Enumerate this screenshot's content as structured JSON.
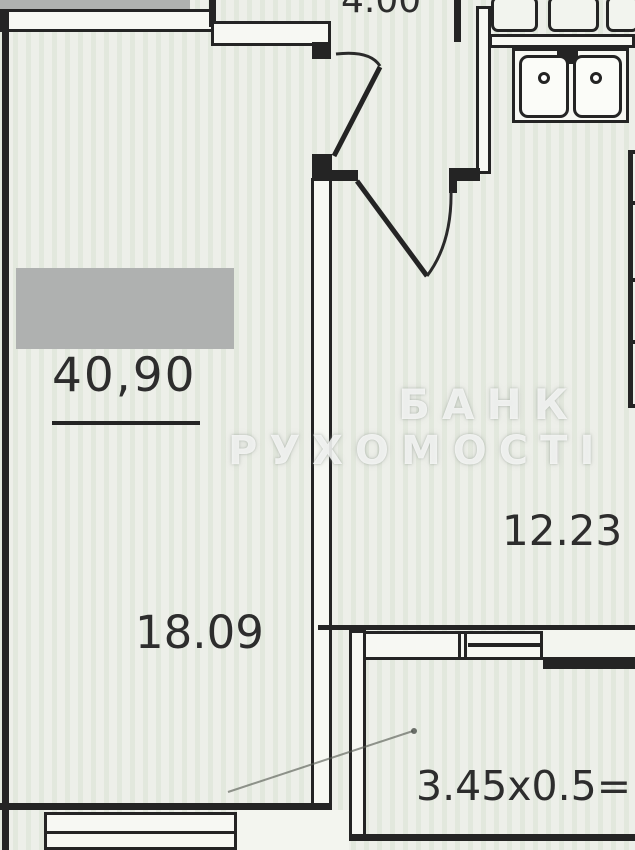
{
  "plan": {
    "description": "apartment floor plan (scanned photo)",
    "labels": {
      "total_area": "40,90",
      "living_room_area": "18.09",
      "kitchen_area": "12.23",
      "corridor_formula": "3.45x0.5=1",
      "top_dimension": "4.00"
    },
    "watermark": {
      "line1": "БАНК",
      "line2": "РУХОМОСТІ"
    },
    "fixtures": [
      "double-sink",
      "wardrobe",
      "kitchen-cabinets",
      "window",
      "door-swings"
    ],
    "colors": {
      "paper": "#edefe9",
      "wall_ink": "#242424",
      "redaction_grey": "#afb1b0",
      "text": "#2d2d2d",
      "watermark_white": "rgba(255,255,255,0.78)"
    }
  }
}
